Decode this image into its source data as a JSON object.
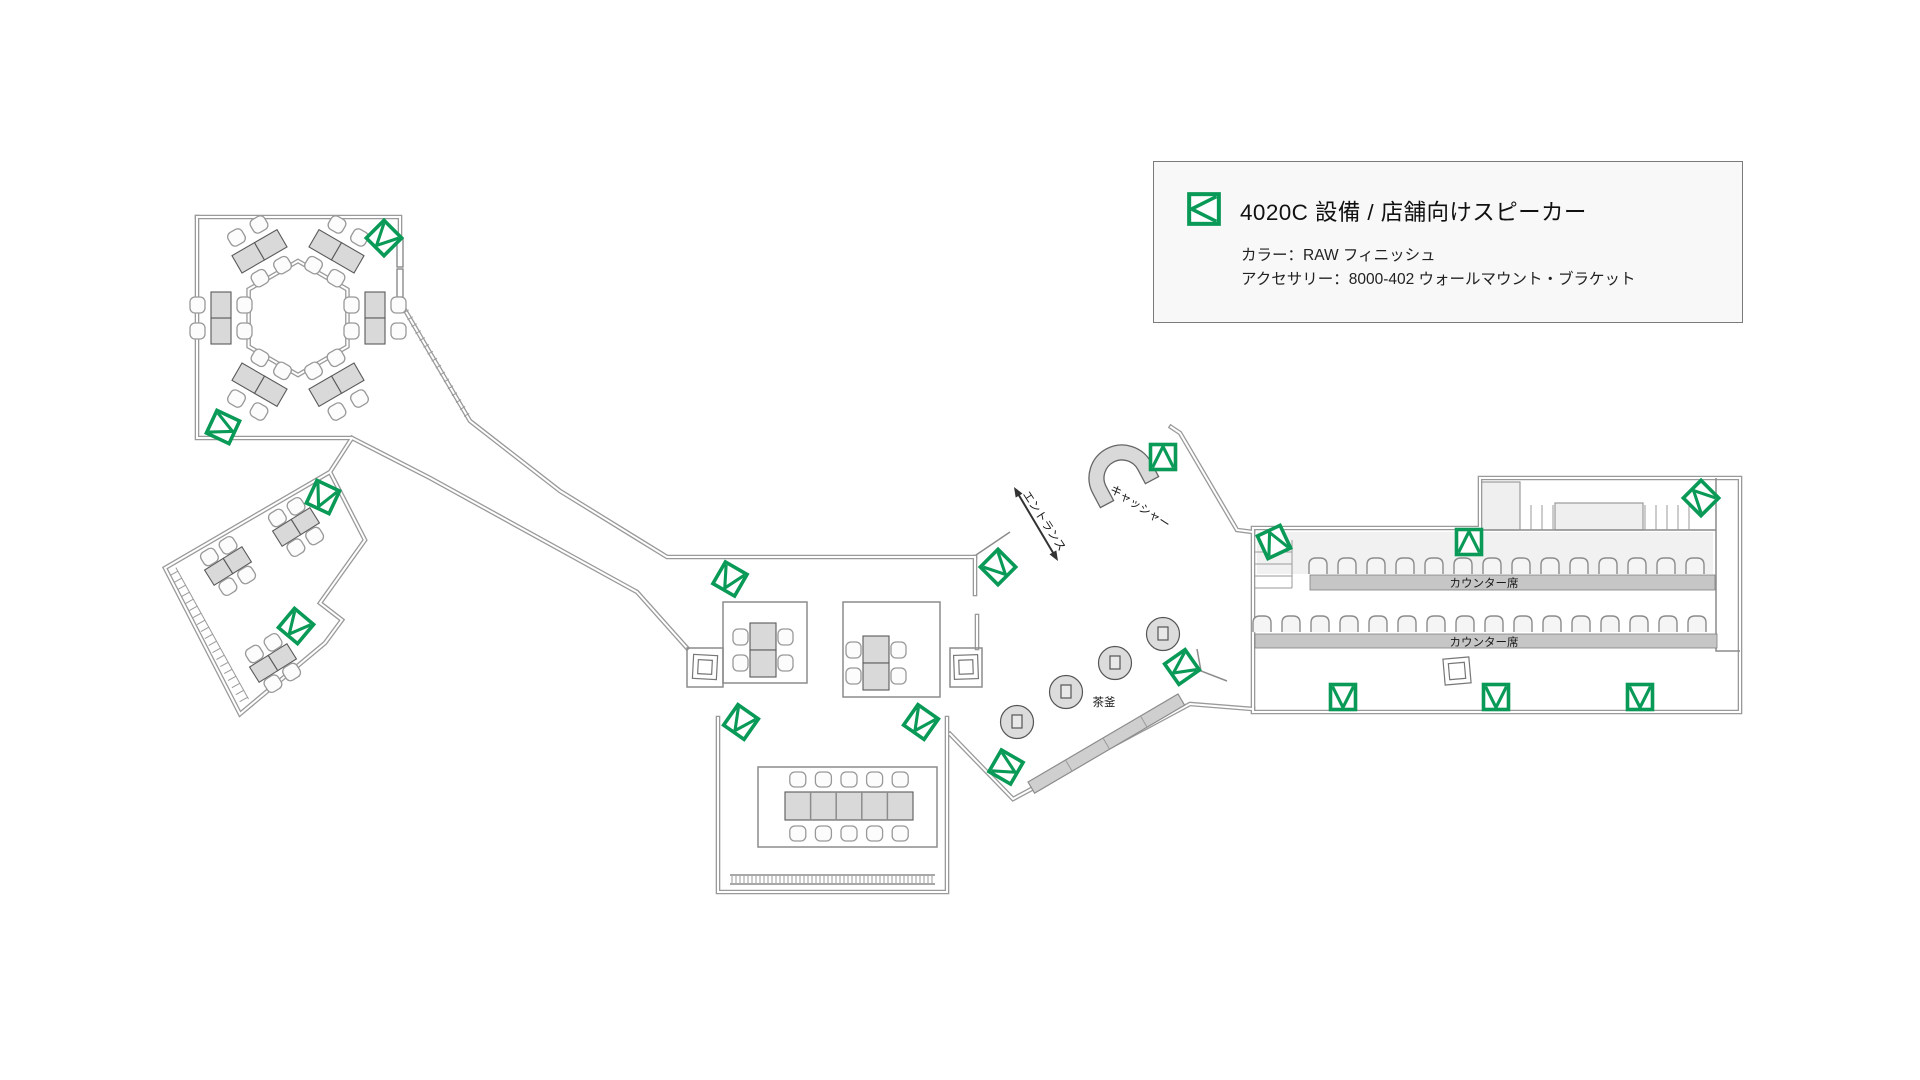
{
  "page": {
    "background": "#ffffff"
  },
  "legend": {
    "title": "4020C 設備 / 店舗向けスピーカー",
    "color_line": "カラー：RAW フィニッシュ",
    "accessory_line": "アクセサリー：8000-402 ウォールマウント・ブラケット",
    "icon": "speaker-plan-symbol",
    "accent_color": "#0a9a57"
  },
  "plan_labels": {
    "entrance": {
      "text": "エントランス",
      "x": 1041,
      "y": 523,
      "rot": 57
    },
    "cashier": {
      "text": "キャッシャー",
      "x": 1138,
      "y": 510,
      "rot": 33
    },
    "tea_kettle": {
      "text": "茶釜",
      "x": 1104,
      "y": 706,
      "rot": 0
    },
    "counter_1": {
      "text": "カウンター席",
      "x": 1484,
      "y": 587,
      "rot": 0
    },
    "counter_2": {
      "text": "カウンター席",
      "x": 1484,
      "y": 646,
      "rot": 0
    }
  },
  "speakers": {
    "model": "4020C",
    "color_hex": "#0a9a57",
    "count": 17,
    "positions": [
      {
        "x": 384,
        "y": 238,
        "r": 225
      },
      {
        "x": 223,
        "y": 427,
        "r": 115
      },
      {
        "x": 323,
        "y": 497,
        "r": 205
      },
      {
        "x": 296,
        "y": 626,
        "r": 220
      },
      {
        "x": 730,
        "y": 579,
        "r": 210
      },
      {
        "x": 741,
        "y": 722,
        "r": 215
      },
      {
        "x": 921,
        "y": 722,
        "r": 215
      },
      {
        "x": 1006,
        "y": 767,
        "r": 120
      },
      {
        "x": 998,
        "y": 567,
        "r": 135
      },
      {
        "x": 1163,
        "y": 457,
        "r": 0
      },
      {
        "x": 1182,
        "y": 667,
        "r": 235
      },
      {
        "x": 1274,
        "y": 542,
        "r": 335
      },
      {
        "x": 1469,
        "y": 542,
        "r": 0
      },
      {
        "x": 1701,
        "y": 498,
        "r": 315
      },
      {
        "x": 1343,
        "y": 697,
        "r": 180
      },
      {
        "x": 1496,
        "y": 697,
        "r": 180
      },
      {
        "x": 1640,
        "y": 697,
        "r": 180
      }
    ]
  },
  "counter_rows": [
    {
      "x0": 1318,
      "y": 566,
      "count": 14,
      "dx": 29
    },
    {
      "x0": 1262,
      "y": 624,
      "count": 16,
      "dx": 29
    }
  ]
}
